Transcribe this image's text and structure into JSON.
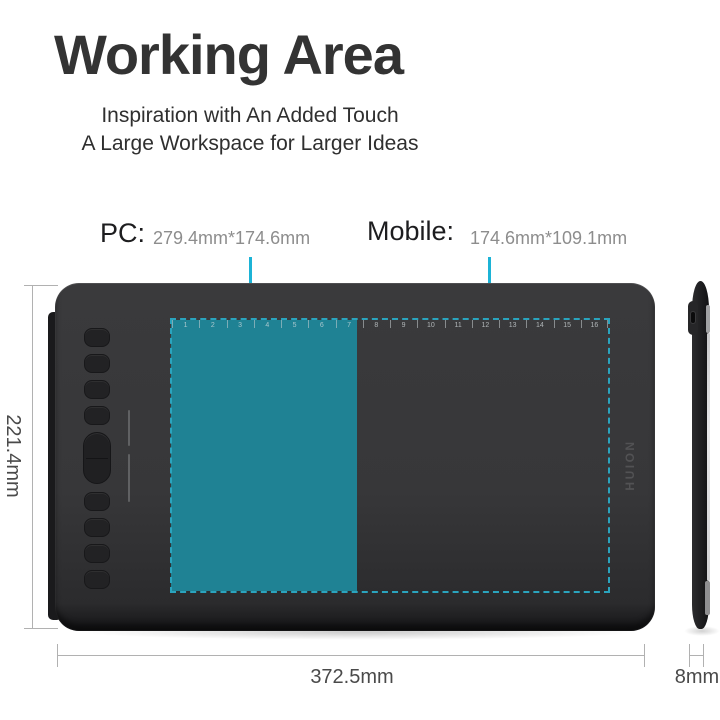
{
  "header": {
    "title": "Working Area",
    "subtitle_lines": [
      "Inspiration with An Added Touch",
      "A Large Workspace for Larger Ideas"
    ]
  },
  "callouts": {
    "pc": {
      "label": "PC:",
      "size": "279.4mm*174.6mm"
    },
    "mobile": {
      "label": "Mobile:",
      "size": "174.6mm*109.1mm"
    }
  },
  "dimensions": {
    "height_label": "221.4mm",
    "width_label": "372.5mm",
    "thickness_label": "8mm"
  },
  "tablet": {
    "brand_logo": "HUION",
    "ruler_numbers": [
      "1",
      "2",
      "3",
      "4",
      "5",
      "6",
      "7",
      "8",
      "9",
      "10",
      "11",
      "12",
      "13",
      "14",
      "15",
      "16"
    ]
  },
  "colors": {
    "teal_fill": "#1F8294",
    "cyan_dashed": "#2AA4BE",
    "cyan_pointer": "#1CB3D6",
    "tablet_surface": "#39393B",
    "tablet_frame": "#1B1B1D",
    "title_text": "#333333",
    "size_text": "#8D8D8D",
    "dimension_text": "#4A4A4A"
  }
}
